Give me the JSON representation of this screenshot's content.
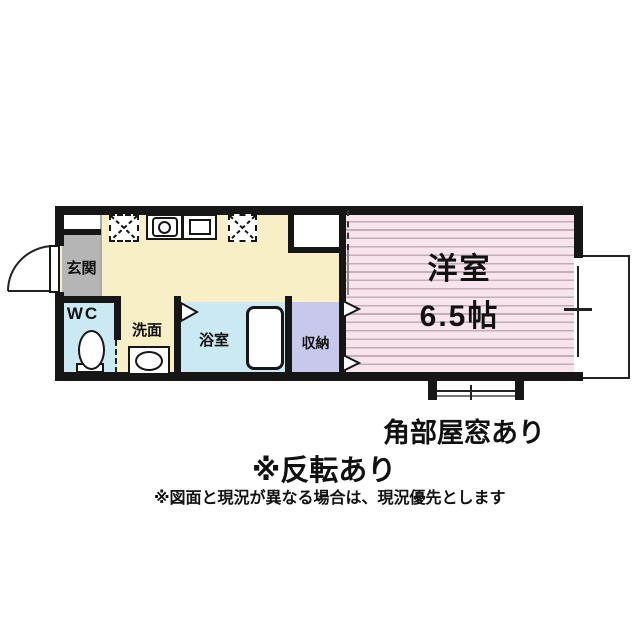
{
  "floorplan": {
    "rooms": [
      {
        "id": "genkan",
        "label": "玄関"
      },
      {
        "id": "wc",
        "label": "WC"
      },
      {
        "id": "senmen",
        "label": "洗面"
      },
      {
        "id": "yokushitsu",
        "label": "浴室"
      },
      {
        "id": "shuno",
        "label": "収納"
      },
      {
        "id": "yoshitsu",
        "label": "洋室",
        "size": "6.5帖"
      }
    ],
    "fixtures": [
      "entrance-door",
      "toilet",
      "wash-basin",
      "bathtub",
      "kitchen-sink",
      "stove",
      "appliance-space",
      "sliding-door",
      "closet-doors",
      "window-right",
      "window-bottom",
      "balcony"
    ],
    "colors": {
      "wall": "#161616",
      "kitchen_floor": "#F8EFC6",
      "entrance_floor": "#B5B5B5",
      "wet_area_floor": "#CBE9F3",
      "storage_floor": "#C8C8EC",
      "western_room_floor": "#F7E4ED",
      "western_room_stripe": "#C6ACBB"
    }
  },
  "notes": {
    "corner_window": "角部屋窓あり",
    "reversed": "※反転あり",
    "disclaimer": "※図面と現況が異なる場合は、現況優先とします"
  }
}
